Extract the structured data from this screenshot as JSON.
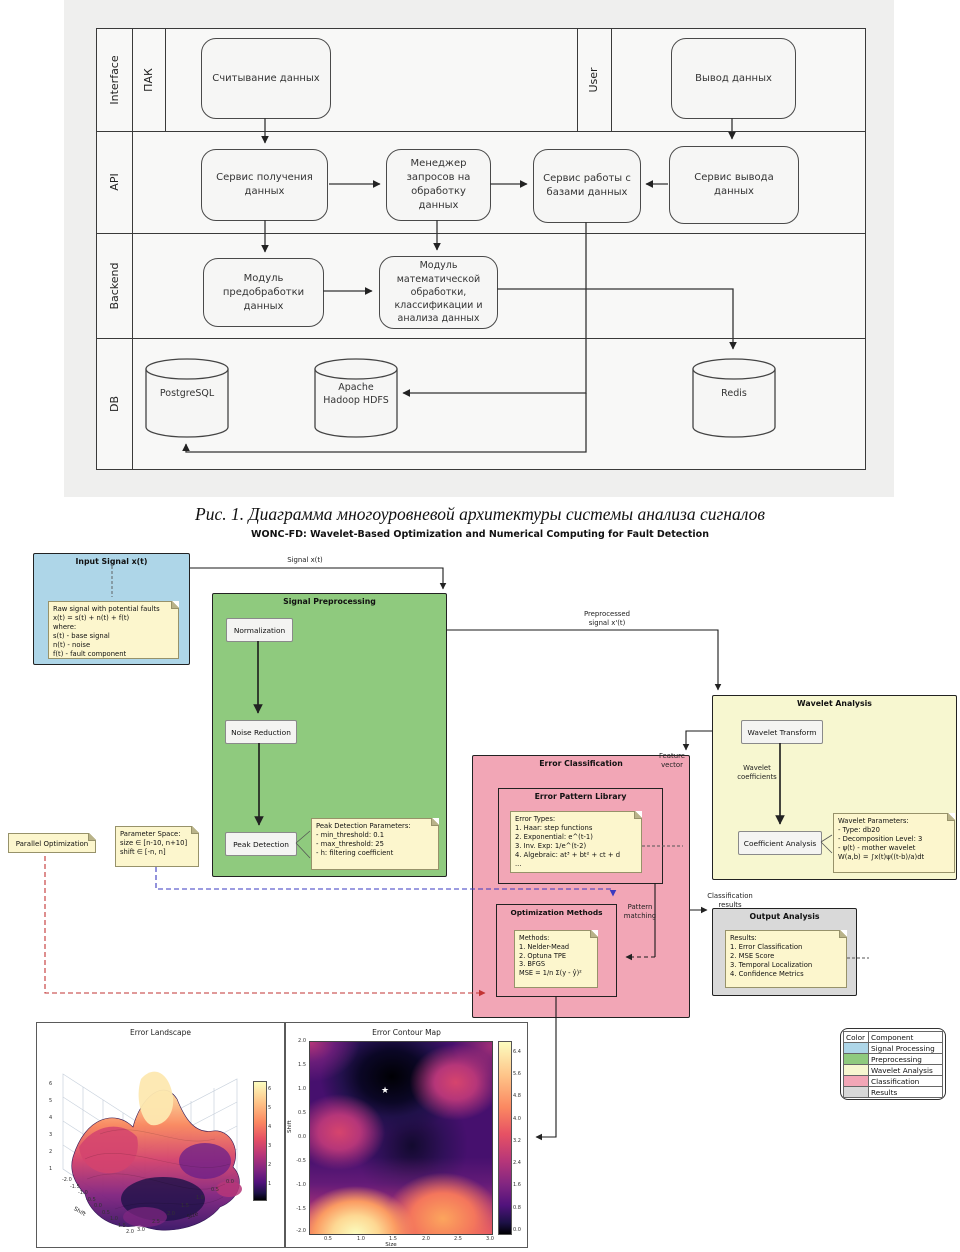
{
  "fig1": {
    "caption": "Рис. 1. Диаграмма многоуровневой архитектуры системы анализа сигналов",
    "layers": [
      "Interface",
      "API",
      "Backend",
      "DB"
    ],
    "lane_pak": "ПАК",
    "lane_user": "User",
    "nodes": {
      "read": "Считывание данных",
      "output": "Вывод данных",
      "svc_in": "Сервис получения данных",
      "manager": "Менеджер запросов на обработку данных",
      "svc_db": "Сервис работы с базами данных",
      "svc_out": "Сервис вывода данных",
      "preproc": "Модуль предобработки данных",
      "math": "Модуль математической обработки, классификации и анализа данных",
      "postgres": "PostgreSQL",
      "hdfs": "Apache Hadoop HDFS",
      "redis": "Redis"
    }
  },
  "fc": {
    "title": "WONC-FD: Wavelet-Based Optimization and Numerical Computing for Fault Detection",
    "input": {
      "title": "Input Signal x(t)",
      "note": [
        "Raw signal with potential faults",
        "x(t) = s(t) + n(t) + f(t)",
        "where:",
        "s(t) - base signal",
        "n(t) - noise",
        "f(t) - fault component"
      ]
    },
    "pre": {
      "title": "Signal Preprocessing",
      "steps": [
        "Normalization",
        "Noise Reduction",
        "Peak Detection"
      ],
      "note": [
        "Peak Detection Parameters:",
        "- min_threshold: 0.1",
        "- max_threshold: 25",
        "- h: filtering coefficient"
      ]
    },
    "wav": {
      "title": "Wavelet Analysis",
      "transform": "Wavelet Transform",
      "coeff": "Coefficient Analysis",
      "coeff_label": [
        "Wavelet",
        "coefficients"
      ],
      "note": [
        "Wavelet Parameters:",
        "- Type: db20",
        "- Decomposition Level: 3",
        "- ψ(t) - mother wavelet",
        "W(a,b) = ∫x(t)ψ((t-b)/a)dt"
      ]
    },
    "cls": {
      "title": "Error Classification",
      "lib": {
        "title": "Error Pattern Library",
        "note": [
          "Error Types:",
          "1. Haar: step functions",
          "2. Exponential: e^(t-1)",
          "3. Inv. Exp: 1/e^(t-2)",
          "4. Algebraic: at³ + bt² + ct + d",
          "..."
        ]
      },
      "opt": {
        "title": "Optimization Methods",
        "note": [
          "Methods:",
          "1. Nelder-Mead",
          "2. Optuna TPE",
          "3. BFGS",
          "MSE = 1/n Σ(y - ŷ)²"
        ]
      }
    },
    "out": {
      "title": "Output Analysis",
      "note": [
        "Results:",
        "1. Error Classification",
        "2. MSE Score",
        "3. Temporal Localization",
        "4. Confidence Metrics"
      ]
    },
    "side": {
      "parallel": "Parallel Optimization",
      "param": [
        "Parameter Space:",
        "size ∈ [n-10, n+10]",
        "shift ∈ [-n, n]"
      ]
    },
    "edges": {
      "signal": "Signal x(t)",
      "pre": [
        "Preprocessed",
        "signal x'(t)"
      ],
      "feature": [
        "Feature",
        "vector"
      ],
      "pattern": [
        "Pattern",
        "matching"
      ],
      "cls": [
        "Classification",
        "results"
      ]
    },
    "legend": {
      "headers": [
        "Color",
        "Component"
      ],
      "rows": [
        {
          "color": "#aed6e8",
          "label": "Signal Processing"
        },
        {
          "color": "#8fca7e",
          "label": "Preprocessing"
        },
        {
          "color": "#f7f7d0",
          "label": "Wavelet Analysis"
        },
        {
          "color": "#f2a6b6",
          "label": "Classification"
        },
        {
          "color": "#d9d9d9",
          "label": "Results"
        }
      ]
    }
  },
  "chart_data": [
    {
      "type": "surface",
      "title": "Error Landscape",
      "xlabel": "Size",
      "ylabel": "Shift",
      "shift_ticks": [
        "-2.0",
        "-1.5",
        "-1.0",
        "-0.5",
        "0.0",
        "0.5",
        "1.0",
        "1.5",
        "2.0"
      ],
      "size_ticks": [
        "3.0",
        "2.5",
        "2.0",
        "1.5",
        "1.0",
        "0.5",
        "0.0"
      ],
      "z_ticks": [
        "1",
        "2",
        "3",
        "4",
        "5",
        "6"
      ],
      "colorbar_ticks": [
        "6",
        "5",
        "4",
        "3",
        "2",
        "1"
      ],
      "zlim": [
        0,
        6
      ],
      "x_range": [
        0,
        3
      ],
      "y_range": [
        -2,
        2
      ],
      "colormap": "magma",
      "description": "3D error surface over (Size, Shift); high peach-colored ridge near shift -1..0, dark low-error valleys in the center and bottom"
    },
    {
      "type": "contour",
      "title": "Error Contour Map",
      "xlabel": "Size",
      "ylabel": "Shift",
      "x_ticks": [
        "0.5",
        "1.0",
        "1.5",
        "2.0",
        "2.5",
        "3.0"
      ],
      "y_ticks": [
        "2.0",
        "1.5",
        "1.0",
        "0.5",
        "0.0",
        "-0.5",
        "-1.0",
        "-1.5",
        "-2.0"
      ],
      "colorbar_ticks": [
        "6.4",
        "5.6",
        "4.8",
        "4.0",
        "3.2",
        "2.4",
        "1.6",
        "0.8",
        "0.0"
      ],
      "colormap": "magma",
      "marker": {
        "symbol": "star",
        "glyph": "★",
        "x": 1.35,
        "y": 0.85
      },
      "description": "dark low-error basin near (1.4, 0.9) marked with white star; bright high-error region along bottom edge, brightest at (0.7, -2.0)"
    }
  ]
}
